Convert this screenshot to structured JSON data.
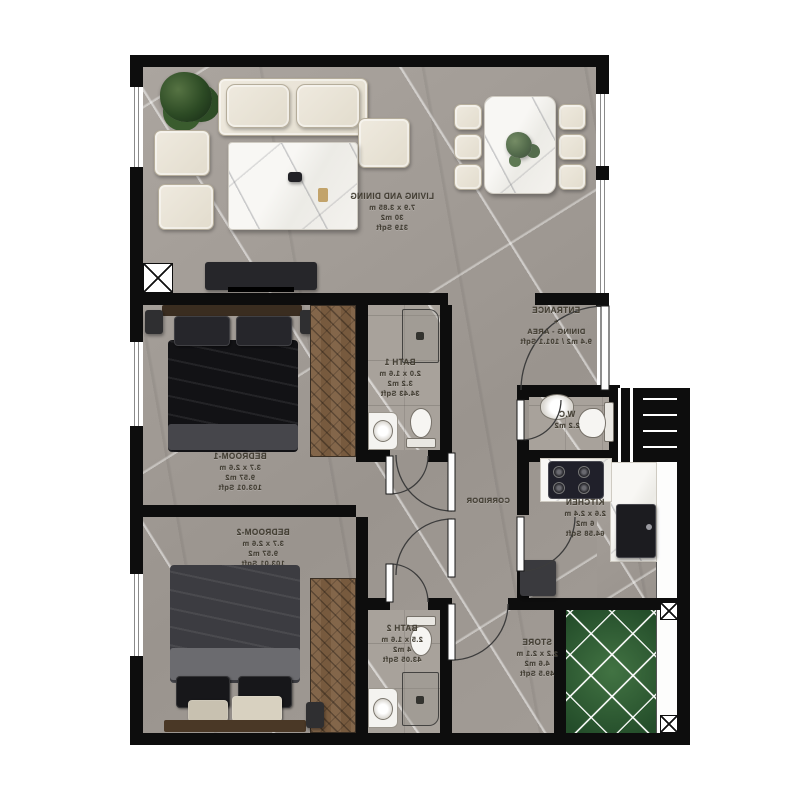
{
  "plan_title": "2-bedroom apartment floor plan (mirrored render)",
  "labels": {
    "living": [
      "LIVING AND DINING",
      "7.9 x 3.85 m",
      "30  m2",
      "319 Sqft"
    ],
    "bedroom1": [
      "BEDROOM-1",
      "3.7 x 2.6 m",
      "9.57 m2",
      "103.01 Sqft"
    ],
    "bath1": [
      "BATH 1",
      "2.0 x 1.6 m",
      "3.2 m2",
      "34.43 Sqft"
    ],
    "entrance": [
      "ENTRANCE",
      "+",
      "DINING - AREA",
      "9.4 m2 / 101.1 Sqft"
    ],
    "wc": [
      "W.C",
      "2.2 m2"
    ],
    "kitchen": [
      "KITCHEN",
      "2.6 x 2.4 m",
      "6  m2",
      "64.58 Sqft"
    ],
    "corridor": [
      "CORRIDOR"
    ],
    "bedroom2": [
      "BEDROOM-2",
      "3.7 x 2.6 m",
      "9.57 m2",
      "103.01 Sqft"
    ],
    "bath2": [
      "BATH 2",
      "2.5 x 1.6 m",
      "4  m2",
      "43.05 Sqft"
    ],
    "store": [
      "STORE",
      "2.2 x 2.1 m",
      "4.6  m2",
      "49.5 Sqft"
    ]
  },
  "palette": {
    "wall": "#0d0d0d",
    "floor_marble_grey": "#a39e97",
    "bath_tile": "#a8a29b",
    "wardrobe_wood": "#7d6147",
    "patio_green": "#35663c",
    "label_ink": "#3f3a2e",
    "furniture_cream": "#ebe6da",
    "marble_white": "#f5f3ef",
    "bed_dark": "#141417"
  }
}
